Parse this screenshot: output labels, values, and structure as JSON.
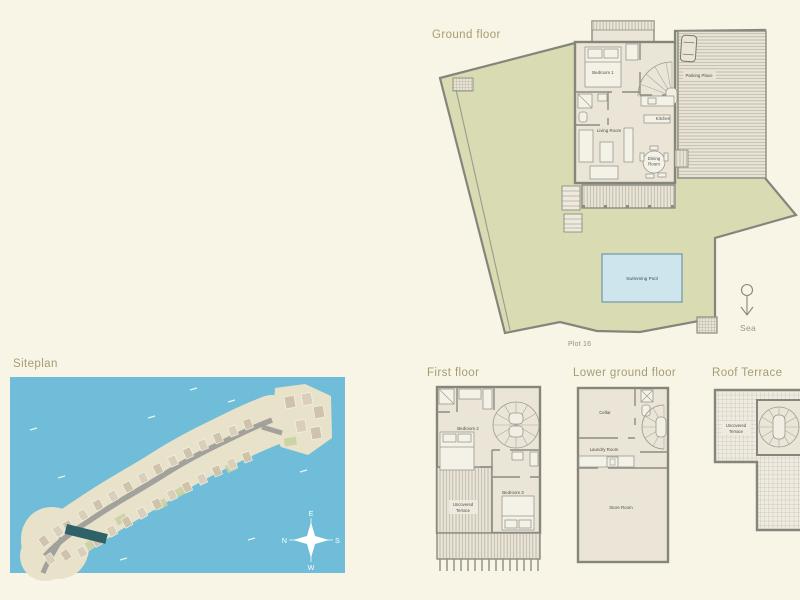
{
  "colors": {
    "background": "#f8f4e6",
    "water": "#6fbdd8",
    "garden": "#d9dcb3",
    "floor": "#ebe5d7",
    "wall": "#85857b",
    "pool": "#cfe5ed",
    "title_text": "#a69d71",
    "island_sand": "#e9e2ca"
  },
  "ground_floor": {
    "title": "Ground floor",
    "labels": {
      "bedroom1": "Bedroom 1",
      "living_room": "Living Room",
      "kitchen": "Kitchen",
      "dining": [
        "Dining",
        "Room"
      ],
      "parking": "Parking Place",
      "pool": "Swimming Pool"
    },
    "plot_label": "Plot 16",
    "sea_label": "Sea"
  },
  "siteplan": {
    "title": "Siteplan",
    "compass": {
      "e": "E",
      "n": "N",
      "s": "S",
      "w": "W"
    }
  },
  "first_floor": {
    "title": "First floor",
    "labels": {
      "bedroom2": "Bedroom 2",
      "bedroom3": "Bedroom 3",
      "terrace": [
        "Uncovered",
        "Terrace"
      ]
    }
  },
  "lower_ground_floor": {
    "title": "Lower ground floor",
    "labels": {
      "cellar": "Cellar",
      "laundry": "Laundry Room",
      "store": "Store Room"
    }
  },
  "roof_terrace": {
    "title": "Roof Terrace",
    "labels": {
      "terrace": [
        "Uncovered",
        "Terrace"
      ]
    }
  }
}
